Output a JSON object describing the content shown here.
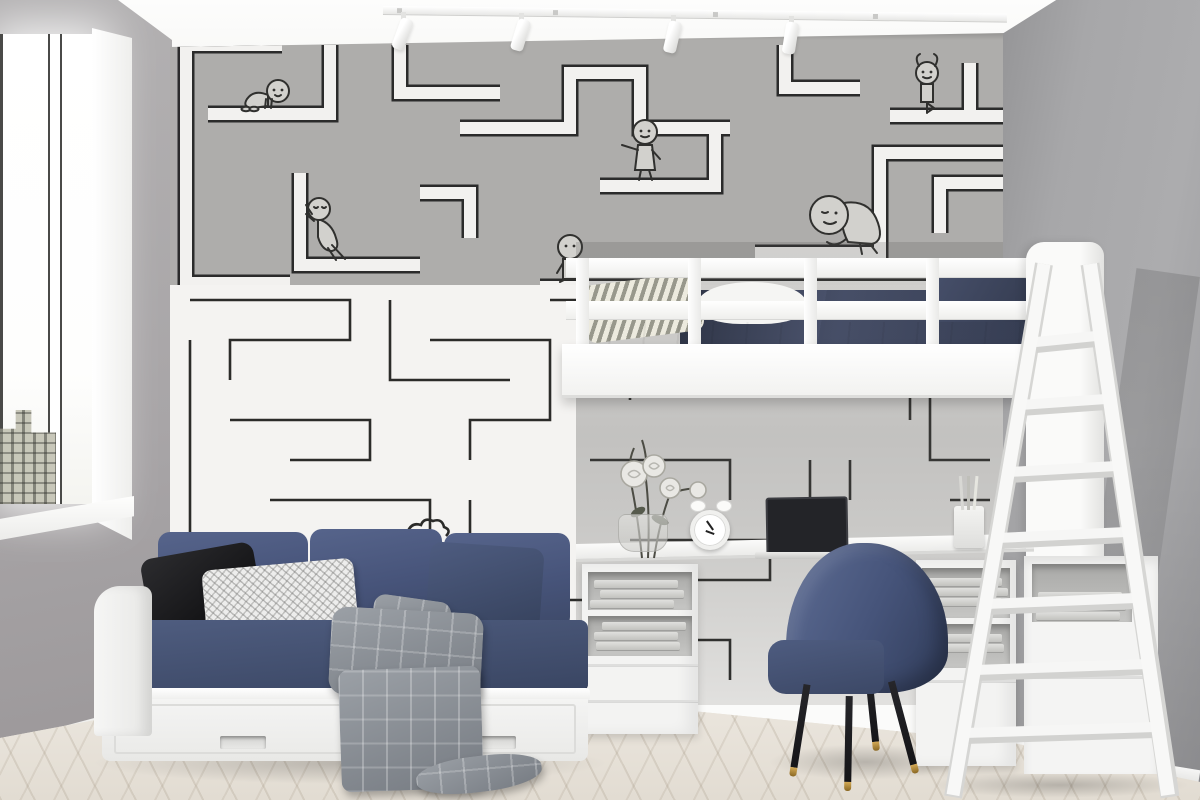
{
  "scene": {
    "type": "interior-photograph",
    "description": "Kids bedroom with maze wallpaper feature wall, white loft bed with ladder, desk nook underneath, blue day-bed sofa and blue desk chair",
    "objects": [
      "window",
      "city-building-view",
      "track-lighting",
      "maze-wallpaper-upper-gray",
      "maze-wallpaper-lower-white",
      "stick-figure-characters",
      "loft-bed",
      "bed-guardrail",
      "bedding",
      "bed-end-panel",
      "ladder",
      "desk",
      "laptop",
      "alarm-clock",
      "flower-vase",
      "pencil-cup",
      "book-shelves",
      "desk-chair",
      "day-bed-sofa",
      "sofa-drawers",
      "throw-pillows",
      "plaid-blanket",
      "herringbone-floor"
    ],
    "characters": [
      {
        "name": "crawling-figure",
        "pose": "crawling along a maze path"
      },
      {
        "name": "pushing-figure",
        "pose": "leaning and pushing a maze wall"
      },
      {
        "name": "pointing-figure",
        "pose": "standing and pointing"
      },
      {
        "name": "walking-figure",
        "pose": "strolling on a maze path"
      },
      {
        "name": "lounging-figure",
        "pose": "sitting and leaning on a maze ledge"
      },
      {
        "name": "balancing-figure",
        "pose": "tree pose balance"
      }
    ]
  },
  "colors": {
    "ceiling": "#fbfbfa",
    "wall_left": "#a8a5a7",
    "wall_right": "#a7a7a9",
    "maze_top_bg": "#aeadab",
    "maze_path": "#f2f1ef",
    "maze_outline": "#2b2b2b",
    "maze_bottom_bg": "#f4f3f1",
    "maze_bottom_line": "#2b2b29",
    "char_fill": "#d2d1cd",
    "furniture_white": "#f5f5f4",
    "sofa_blue": "#4f5d80",
    "sofa_blue_dark": "#3a4663",
    "duvet_navy": "#343b50",
    "pillow_black": "#1c1c1e",
    "pillow_white": "#ededec",
    "blanket_gray": "#8f9298",
    "chair_blue": "#46547a",
    "leg_black": "#17171a",
    "brass": "#d3a955",
    "floor": "#e7e2da",
    "building": "#c8c7b9"
  }
}
